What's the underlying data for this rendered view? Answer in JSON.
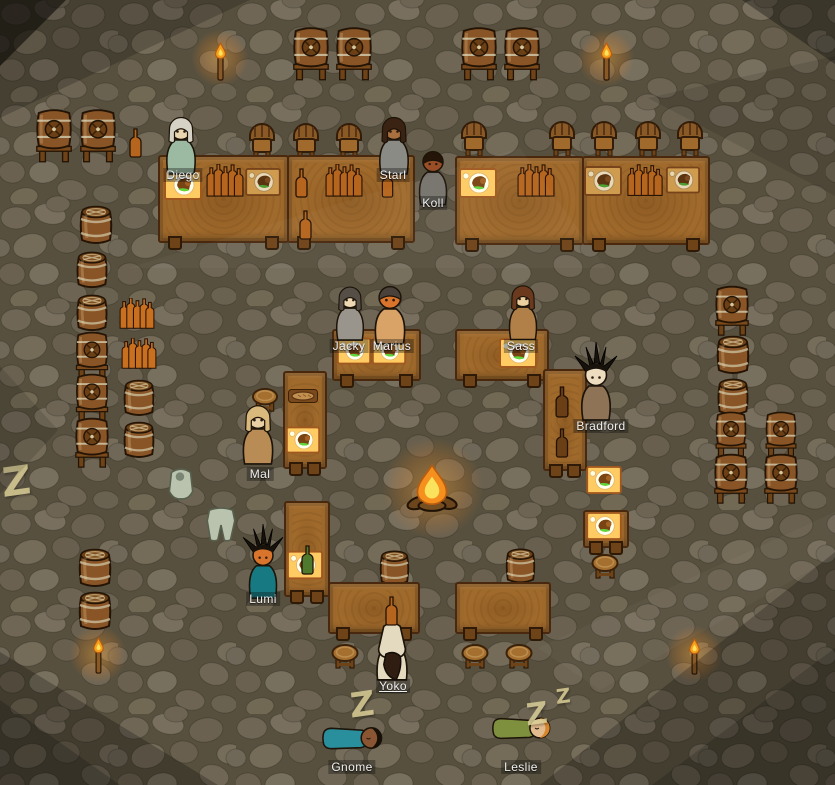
{
  "pawns": [
    {
      "name": "Diego"
    },
    {
      "name": "Starl"
    },
    {
      "name": "Koll"
    },
    {
      "name": "Jacky"
    },
    {
      "name": "Marius"
    },
    {
      "name": "Sass"
    },
    {
      "name": "Mal"
    },
    {
      "name": "Bradford"
    },
    {
      "name": "Lumi"
    },
    {
      "name": "Yoko"
    },
    {
      "name": "Gnome"
    },
    {
      "name": "Leslie"
    }
  ],
  "glyphs": {
    "z": "Z"
  },
  "colors": {
    "floor_base": "#5e5645",
    "mortar": "#57503e",
    "table_wood": "#a06a2c",
    "table_edge": "#49280d",
    "flame": "#f5a01e",
    "label_text": "#f0f0f0",
    "sleep_z": "#d9cd96"
  }
}
